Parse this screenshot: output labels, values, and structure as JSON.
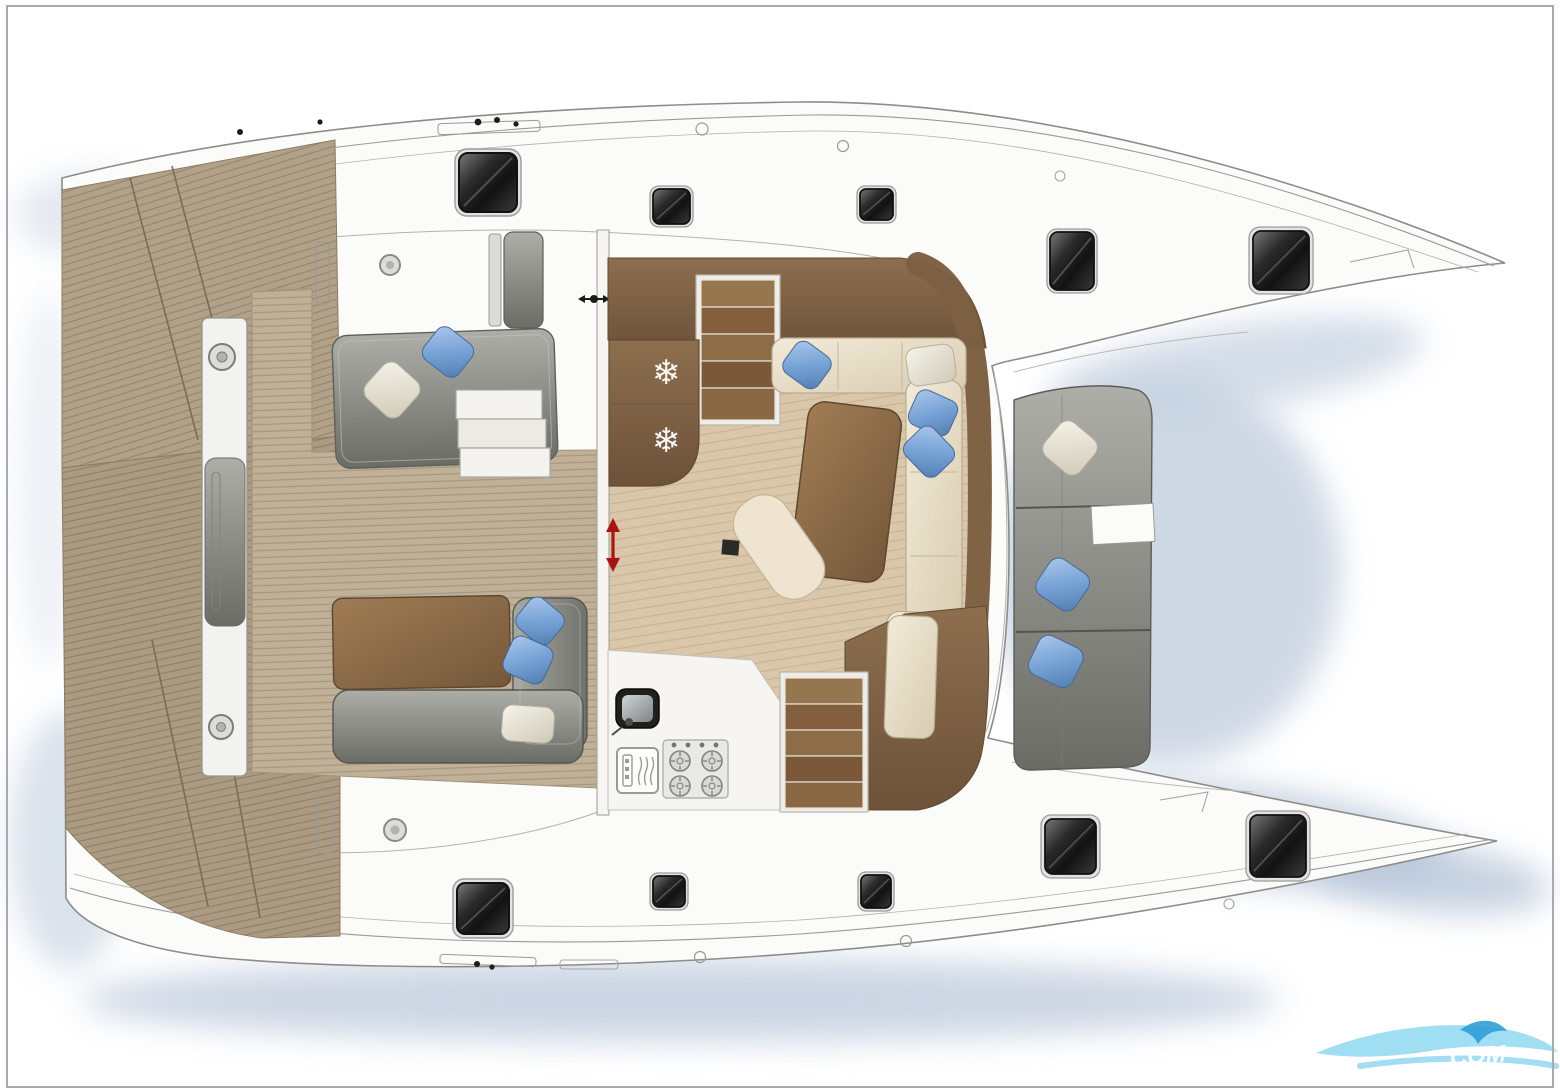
{
  "page": {
    "title": "Catamaran deck and saloon floor plan (top view)",
    "background": "#ffffff",
    "border_color": "#a7abae"
  },
  "watermark": {
    "text": "COM",
    "wave_color": "#8fd8f2",
    "accent_color": "#2f9fd6",
    "text_color": "#ffffff"
  },
  "palette": {
    "hull_white": "#fbfbfa",
    "outline_gray": "#8c8c88",
    "teak": "#b2a189",
    "teak_line": "#93826a",
    "cockpit_teak": "#c0b098",
    "saloon_floor": "#dac6a9",
    "dark_wood": "#8d6f4e",
    "cream_sofa": "#e9dfc9",
    "gray_cushion": "#8f8f8a",
    "blue_pillow": "#78a3d6",
    "white_pillow": "#ece7d9",
    "window_glass": "#1c1c1c",
    "window_frame": "#e2e2e0",
    "shadow_blue": "#c3cfdf",
    "arrow_red": "#a81414"
  },
  "plan": {
    "vessel": "catamaran",
    "view": "top-down deck plan",
    "hulls": [
      {
        "name": "port hull",
        "windows": 5
      },
      {
        "name": "starboard hull",
        "windows": 5
      }
    ],
    "areas": [
      "aft deck",
      "cockpit",
      "saloon",
      "galley",
      "forward seating"
    ],
    "equipment": [
      "double fridge",
      "four-burner stove",
      "oven",
      "sink",
      "companionway stairs port",
      "companionway stairs starboard",
      "sliding door"
    ],
    "icons": [
      "snowflake-icon",
      "stove-burner-icon",
      "oven-icon",
      "sink-icon",
      "double-arrow-icon",
      "deck-fitting-icon",
      "wave-logo-icon"
    ],
    "cushions": {
      "blue": 8,
      "white": 4
    }
  }
}
